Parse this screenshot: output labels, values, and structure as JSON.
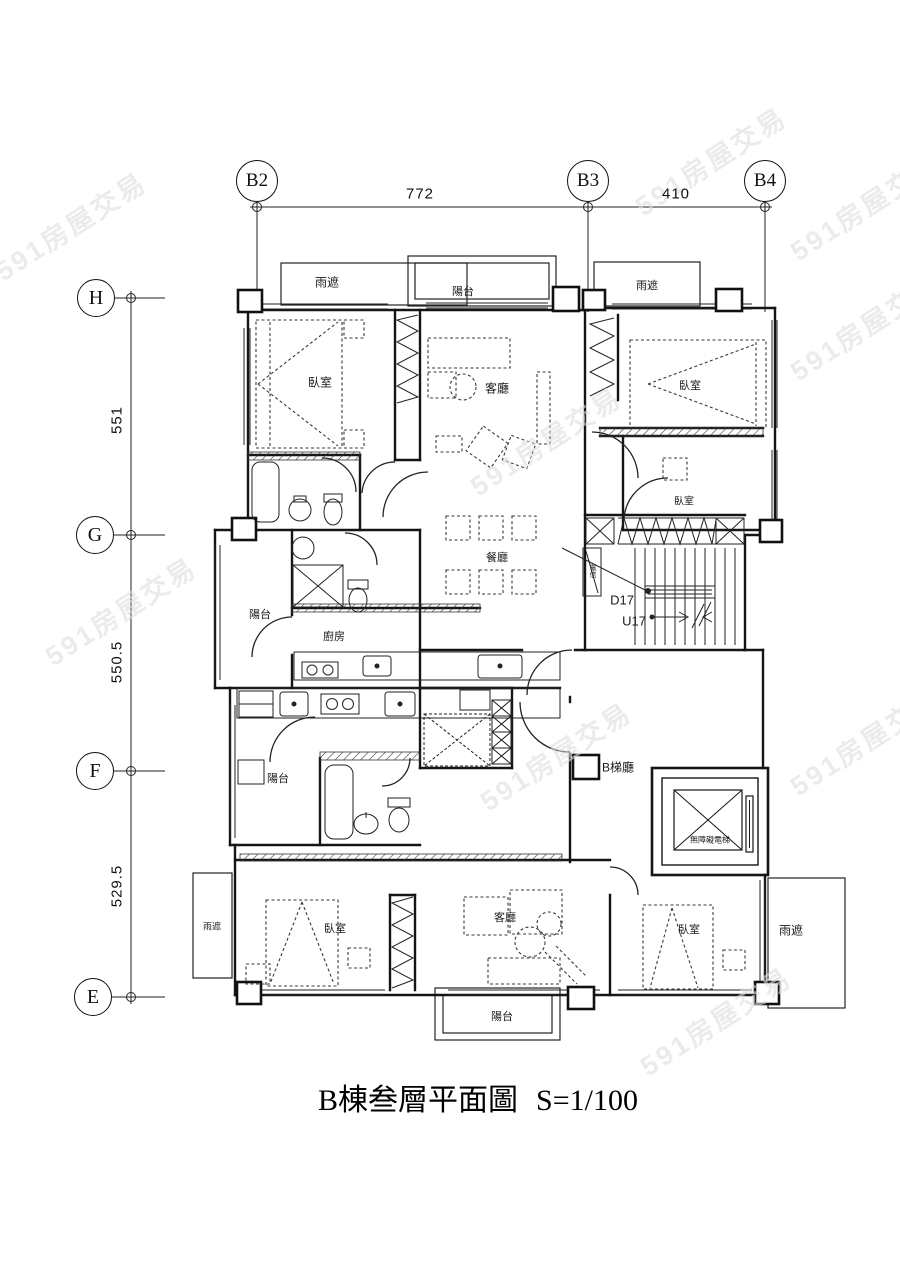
{
  "watermark": {
    "text": "591房屋交易",
    "color": "#dedede",
    "positions": [
      {
        "x": 70,
        "y": 225
      },
      {
        "x": 710,
        "y": 160
      },
      {
        "x": 865,
        "y": 205
      },
      {
        "x": 120,
        "y": 610
      },
      {
        "x": 545,
        "y": 440
      },
      {
        "x": 555,
        "y": 755
      },
      {
        "x": 865,
        "y": 325
      },
      {
        "x": 865,
        "y": 740
      },
      {
        "x": 715,
        "y": 1020
      }
    ]
  },
  "title": {
    "name": "B棟叁層平面圖",
    "scale": "S=1/100"
  },
  "grid": {
    "top": {
      "bubbles": [
        {
          "label": "B2",
          "x": 257,
          "y": 181
        },
        {
          "label": "B3",
          "x": 588,
          "y": 181
        },
        {
          "label": "B4",
          "x": 765,
          "y": 181
        }
      ],
      "dims": [
        {
          "label": "772",
          "x": 420,
          "y": 194
        },
        {
          "label": "410",
          "x": 676,
          "y": 194
        }
      ]
    },
    "left": {
      "bubbles": [
        {
          "label": "H",
          "x": 96,
          "y": 298
        },
        {
          "label": "G",
          "x": 95,
          "y": 535
        },
        {
          "label": "F",
          "x": 95,
          "y": 771
        },
        {
          "label": "E",
          "x": 93,
          "y": 997
        }
      ],
      "dims": [
        {
          "label": "551",
          "x": 117,
          "y": 420
        },
        {
          "label": "550.5",
          "x": 117,
          "y": 662
        },
        {
          "label": "529.5",
          "x": 117,
          "y": 886
        }
      ]
    }
  },
  "plan": {
    "labels": [
      {
        "id": "rain-cover-top-left",
        "text": "雨遮",
        "x": 327,
        "y": 282,
        "size": 12
      },
      {
        "id": "balcony-top",
        "text": "陽台",
        "x": 463,
        "y": 291,
        "size": 11
      },
      {
        "id": "rain-cover-top-right",
        "text": "雨遮",
        "x": 647,
        "y": 285,
        "size": 11
      },
      {
        "id": "bedroom-top-left",
        "text": "臥室",
        "x": 320,
        "y": 382,
        "size": 12
      },
      {
        "id": "living-top",
        "text": "客廳",
        "x": 497,
        "y": 388,
        "size": 12
      },
      {
        "id": "bedroom-top-right",
        "text": "臥室",
        "x": 690,
        "y": 385,
        "size": 11
      },
      {
        "id": "bedroom-mid-right",
        "text": "臥室",
        "x": 684,
        "y": 500,
        "size": 10
      },
      {
        "id": "dining",
        "text": "餐廳",
        "x": 497,
        "y": 557,
        "size": 11
      },
      {
        "id": "telecom-box",
        "text": "電信",
        "x": 592,
        "y": 571,
        "size": 7,
        "vertical": true
      },
      {
        "id": "stair-down",
        "text": "D17",
        "x": 622,
        "y": 600,
        "size": 13
      },
      {
        "id": "stair-up",
        "text": "U17",
        "x": 634,
        "y": 621,
        "size": 13
      },
      {
        "id": "balcony-mid-left",
        "text": "陽台",
        "x": 260,
        "y": 614,
        "size": 11
      },
      {
        "id": "kitchen",
        "text": "廚房",
        "x": 334,
        "y": 636,
        "size": 11
      },
      {
        "id": "balcony-lower-left",
        "text": "陽台",
        "x": 278,
        "y": 778,
        "size": 11
      },
      {
        "id": "stair-hall",
        "text": "B梯廳",
        "x": 618,
        "y": 767,
        "size": 12
      },
      {
        "id": "elevator",
        "text": "無障礙電梯",
        "x": 710,
        "y": 840,
        "size": 8
      },
      {
        "id": "bedroom-bottom-left",
        "text": "臥室",
        "x": 335,
        "y": 928,
        "size": 11
      },
      {
        "id": "living-bottom",
        "text": "客廳",
        "x": 505,
        "y": 917,
        "size": 11
      },
      {
        "id": "bedroom-bottom-right",
        "text": "臥室",
        "x": 689,
        "y": 929,
        "size": 11
      },
      {
        "id": "rain-cover-bot-left",
        "text": "雨遮",
        "x": 212,
        "y": 926,
        "size": 9
      },
      {
        "id": "rain-cover-bot-right",
        "text": "雨遮",
        "x": 791,
        "y": 930,
        "size": 12
      },
      {
        "id": "balcony-bottom",
        "text": "陽台",
        "x": 502,
        "y": 1016,
        "size": 11
      }
    ]
  }
}
